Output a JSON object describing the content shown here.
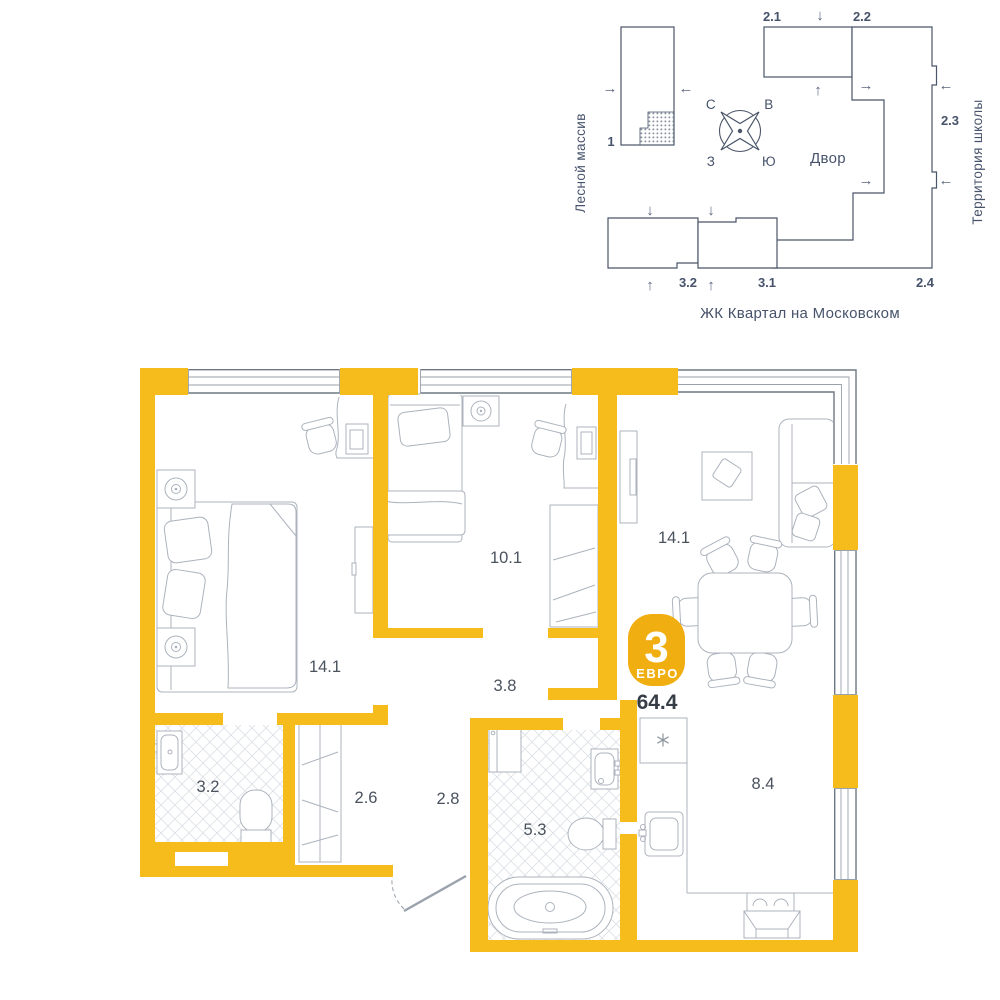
{
  "site_plan": {
    "area_left": "Лесной массив",
    "area_right": "Территория школы",
    "complex_name": "ЖК Квартал на Московском",
    "courtyard": "Двор",
    "compass": {
      "n": "С",
      "e": "В",
      "w": "З",
      "s": "Ю"
    },
    "buildings": {
      "b1": "1",
      "b21": "2.1",
      "b22": "2.2",
      "b23": "2.3",
      "b24": "2.4",
      "b31": "3.1",
      "b32": "3.2"
    },
    "icons": {
      "arrow_up": "↑",
      "arrow_down": "↓",
      "arrow_left": "←",
      "arrow_right": "→"
    }
  },
  "floor_plan": {
    "badge": {
      "rooms_count": "3",
      "layout_type": "ЕВРО",
      "total_area": "64.4"
    },
    "rooms": [
      {
        "id": "bedroom-1",
        "area": "14.1"
      },
      {
        "id": "bedroom-2",
        "area": "10.1"
      },
      {
        "id": "living-room",
        "area": "14.1"
      },
      {
        "id": "hall",
        "area": "3.8"
      },
      {
        "id": "bathroom-small",
        "area": "3.2"
      },
      {
        "id": "wardrobe",
        "area": "2.6"
      },
      {
        "id": "hallway",
        "area": "2.8"
      },
      {
        "id": "bathroom-main",
        "area": "5.3"
      },
      {
        "id": "kitchen",
        "area": "8.4"
      }
    ]
  },
  "colors": {
    "wall": "#F5BC1B",
    "badge": "#F0AE10",
    "site_lines": "#4A5568",
    "furniture_lines": "#ACB3BD",
    "window_lines": "#6E7882",
    "label_text": "#4A525E",
    "dark_text": "#363D46"
  }
}
